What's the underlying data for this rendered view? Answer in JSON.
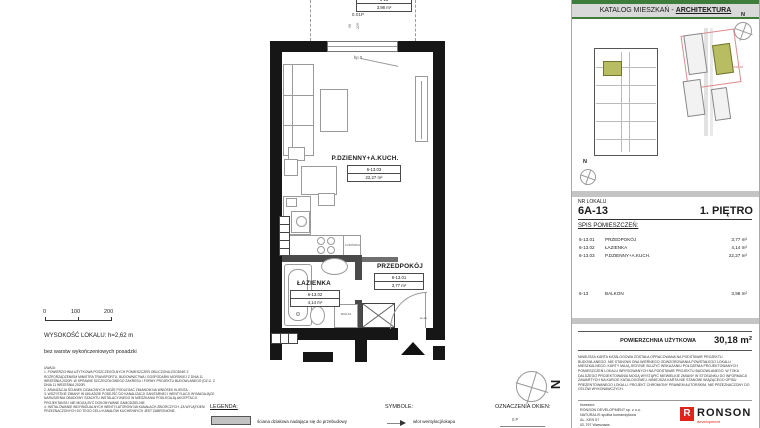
{
  "catalog_header": {
    "prefix": "KATALOG MIESZKAŃ - ",
    "bold": "ARCHITEKTURA"
  },
  "north_letter": "N",
  "unit": {
    "label": "NR LOKALU",
    "number": "6A-13",
    "floor": "1. PIĘTRO"
  },
  "spis": {
    "title": "SPIS POMIESZCZEŃ:",
    "rooms": [
      {
        "code": "6-13.01",
        "name": "PRZEDPOKÓJ",
        "area": "3,77 m²"
      },
      {
        "code": "6-13.02",
        "name": "ŁAZIENKA",
        "area": "4,14 m²"
      },
      {
        "code": "6-13.03",
        "name": "P.DZIENNY+A.KUCH.",
        "area": "22,27 m²"
      }
    ],
    "balcony": {
      "code": "6-13",
      "name": "BALKON",
      "area": "3,98 m²"
    }
  },
  "total": {
    "label": "POWIERZCHNIA UŻYTKOWA",
    "value": "30,18 m²"
  },
  "disclaimer": "NINIEJSZA KARTA KATALOGOWA ZOSTAŁA OPRACOWANA NA PODSTAWIE PROJEKTU BUDOWLANEGO. NIE STANOWI ONA WIERNEGO ODWZOROWANIA POWSTAŁEGO LOKALU MIESZKALNEGO. KARTY MAJĄ JEDYNIE SŁUŻYĆ WSKAZANIU POŁOŻENIA PROJEKTOWANYCH POMIESZCZEŃ LOKALU WRYSOWANYCH NA PODSTAWIE PROJEKTU BUDOWLANEGO. W TOKU DALSZEGO PROJEKTOWANIA MOGĄ WYSTĄPIĆ NIEWIELKIE ZMIANY W STOSUNKU DO INFORMACJI ZAWARTYCH NA KARCIE KATALOGOWEJ. NINIEJSZA KARTA NIE STANOWI WIĄŻĄCEGO OPISU PREZENTOWANEGO LOKALU. PROJEKT CHRONIONY PRAWEM AUTORSKIM. NIE PRZEZNACZONY DO CELÓW WYKONAWCZYCH.",
  "investor": {
    "label": "Inwestor:",
    "line1": "RONSON DEVELOPMENT sp. z o.o.",
    "line2": "NATURALIS spółka komandytowa",
    "line3": "AL. KEN 57",
    "line4": "02-797 Warszawa"
  },
  "logo": {
    "name": "RONSON",
    "tagline": "development",
    "red": "#e2231a"
  },
  "plan": {
    "room_main": {
      "name": "P.DZIENNY+A.KUCH.",
      "code": "6-13.03",
      "area": "22,27 m²"
    },
    "room_bath": {
      "name": "ŁAZIENKA",
      "code": "6-13.02",
      "area": "4,14 m²"
    },
    "room_hall": {
      "name": "PRZEDPOKÓJ",
      "code": "6-13.01",
      "area": "3,77 m²"
    },
    "balcony_box": {
      "code": "6-13",
      "area": "3,98 m²"
    },
    "window_tag": "0.01P",
    "window_dim_a": "98",
    "window_dim_b": "229",
    "sill": "hp 0",
    "fridge": "LODÓWKA",
    "washer": "PRALKA",
    "door_note": "el+tel"
  },
  "scalebar": {
    "t0": "0",
    "t1": "100",
    "t2": "200"
  },
  "height_note": "WYSOKOŚĆ LOKALU: h=2,62 m",
  "height_subnote": "bez warstw wykończeniowych posadzki",
  "uwagi": "UWAGI:\n1. POWIERZCHNIA UŻYTKOWA POSZCZEGÓLNYCH POMIESZCZEŃ OBLICZONA ZGODNIE Z ROZPORZĄDZENIEM MINISTRA TRANSPORTU, BUDOWNICTWA I GOSPODARKI MORSKIEJ Z DNIA 11 WRZEŚNIA 2020R. W SPRAWIE SZCZEGÓŁOWEGO ZAKRESU I FORMY PROJEKTU BUDOWLANEGO (DZ.U. Z DNIA 11 WRZEŚNIA 2020R.\n2. ARANŻACJA ŚCIANEK DZIAŁOWYCH MOŻE PODLEGAĆ ZMIANOM NA WNIOSEK KLIENTA.\n3. WSZYSTKIE ZMIANY W UKŁADZIE PODEJŚĆ DO KANALIZACJI SANITARNEJ I WENTYLACJI WYMAGAJĄCE NARUSZENIA OBUDOWY SZACHTU INSTALACYJNEGO W MIESZKANIU PODLEGAJĄ AKCEPTACJI PROJEKTANTA I NIE MOGĄ BYĆ DOKONYWANE SAMODZIELNIE.\n4. INSTALOWANIE INDYWIDUALNYCH WENTYLATORÓW NA KANAŁACH ZBIORCZYCH, ZA WYJĄTKIEM PRZEZNACZONYCH DO TEGO CELU KANAŁÓW KUCHENNYCH JEST ZABRONIONE.",
  "legend": {
    "title": "LEGENDA:",
    "item": "ściana działowa nadająca się do przebudowy"
  },
  "symbols": {
    "title": "SYMBOLE:",
    "item": "wlot wentylacji/okapu"
  },
  "windows_key": {
    "title": "OZNACZENIA OKIEN:",
    "item": "0.P"
  },
  "site": {
    "etap": "ETAP 6A"
  },
  "colors": {
    "green": "#3e7c3a",
    "olive": "#b9bd62",
    "band": "#c4c4c4"
  }
}
